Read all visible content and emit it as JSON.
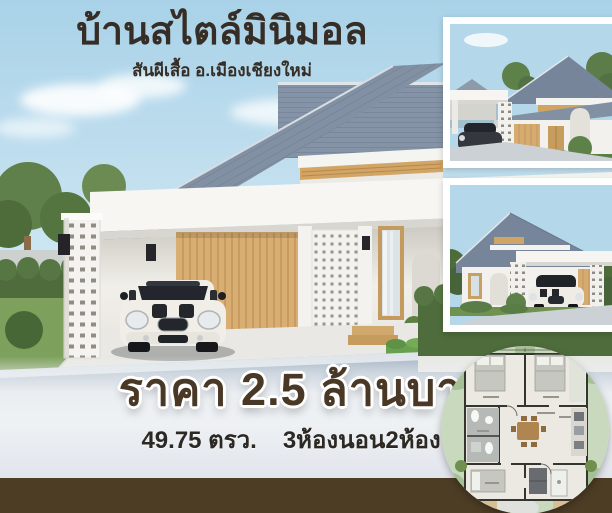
{
  "header": {
    "title": "บ้านสไตล์มินิมอล",
    "subtitle": "สันผีเสื้อ อ.เมืองเชียงใหม่"
  },
  "footer": {
    "price": "ราคา 2.5 ล้านบาท",
    "area": "49.75 ตรว.",
    "rooms": "3ห้องนอน2ห้องน้ำ"
  },
  "photos": {
    "main_alt": "3D render of white minimal-style house, gray gable roof, carport with white Mini Cooper",
    "thumb_top_alt": "house render, front-right angle with carport",
    "thumb_middle_alt": "house render, front-left angle with white Mini under carport",
    "floorplan_alt": "circular floor plan: 3 bedrooms, 2 bathrooms, living-dining, kitchen"
  },
  "colors": {
    "sky": "#b5d8ea",
    "roof": "#8290a3",
    "wood": "#d5ab70",
    "title_text": "#362e26",
    "price_text": "#4a3826",
    "band": "#eef1f4",
    "bottom_strip": "#4d3d25",
    "greenery": "#4f6d3c"
  }
}
